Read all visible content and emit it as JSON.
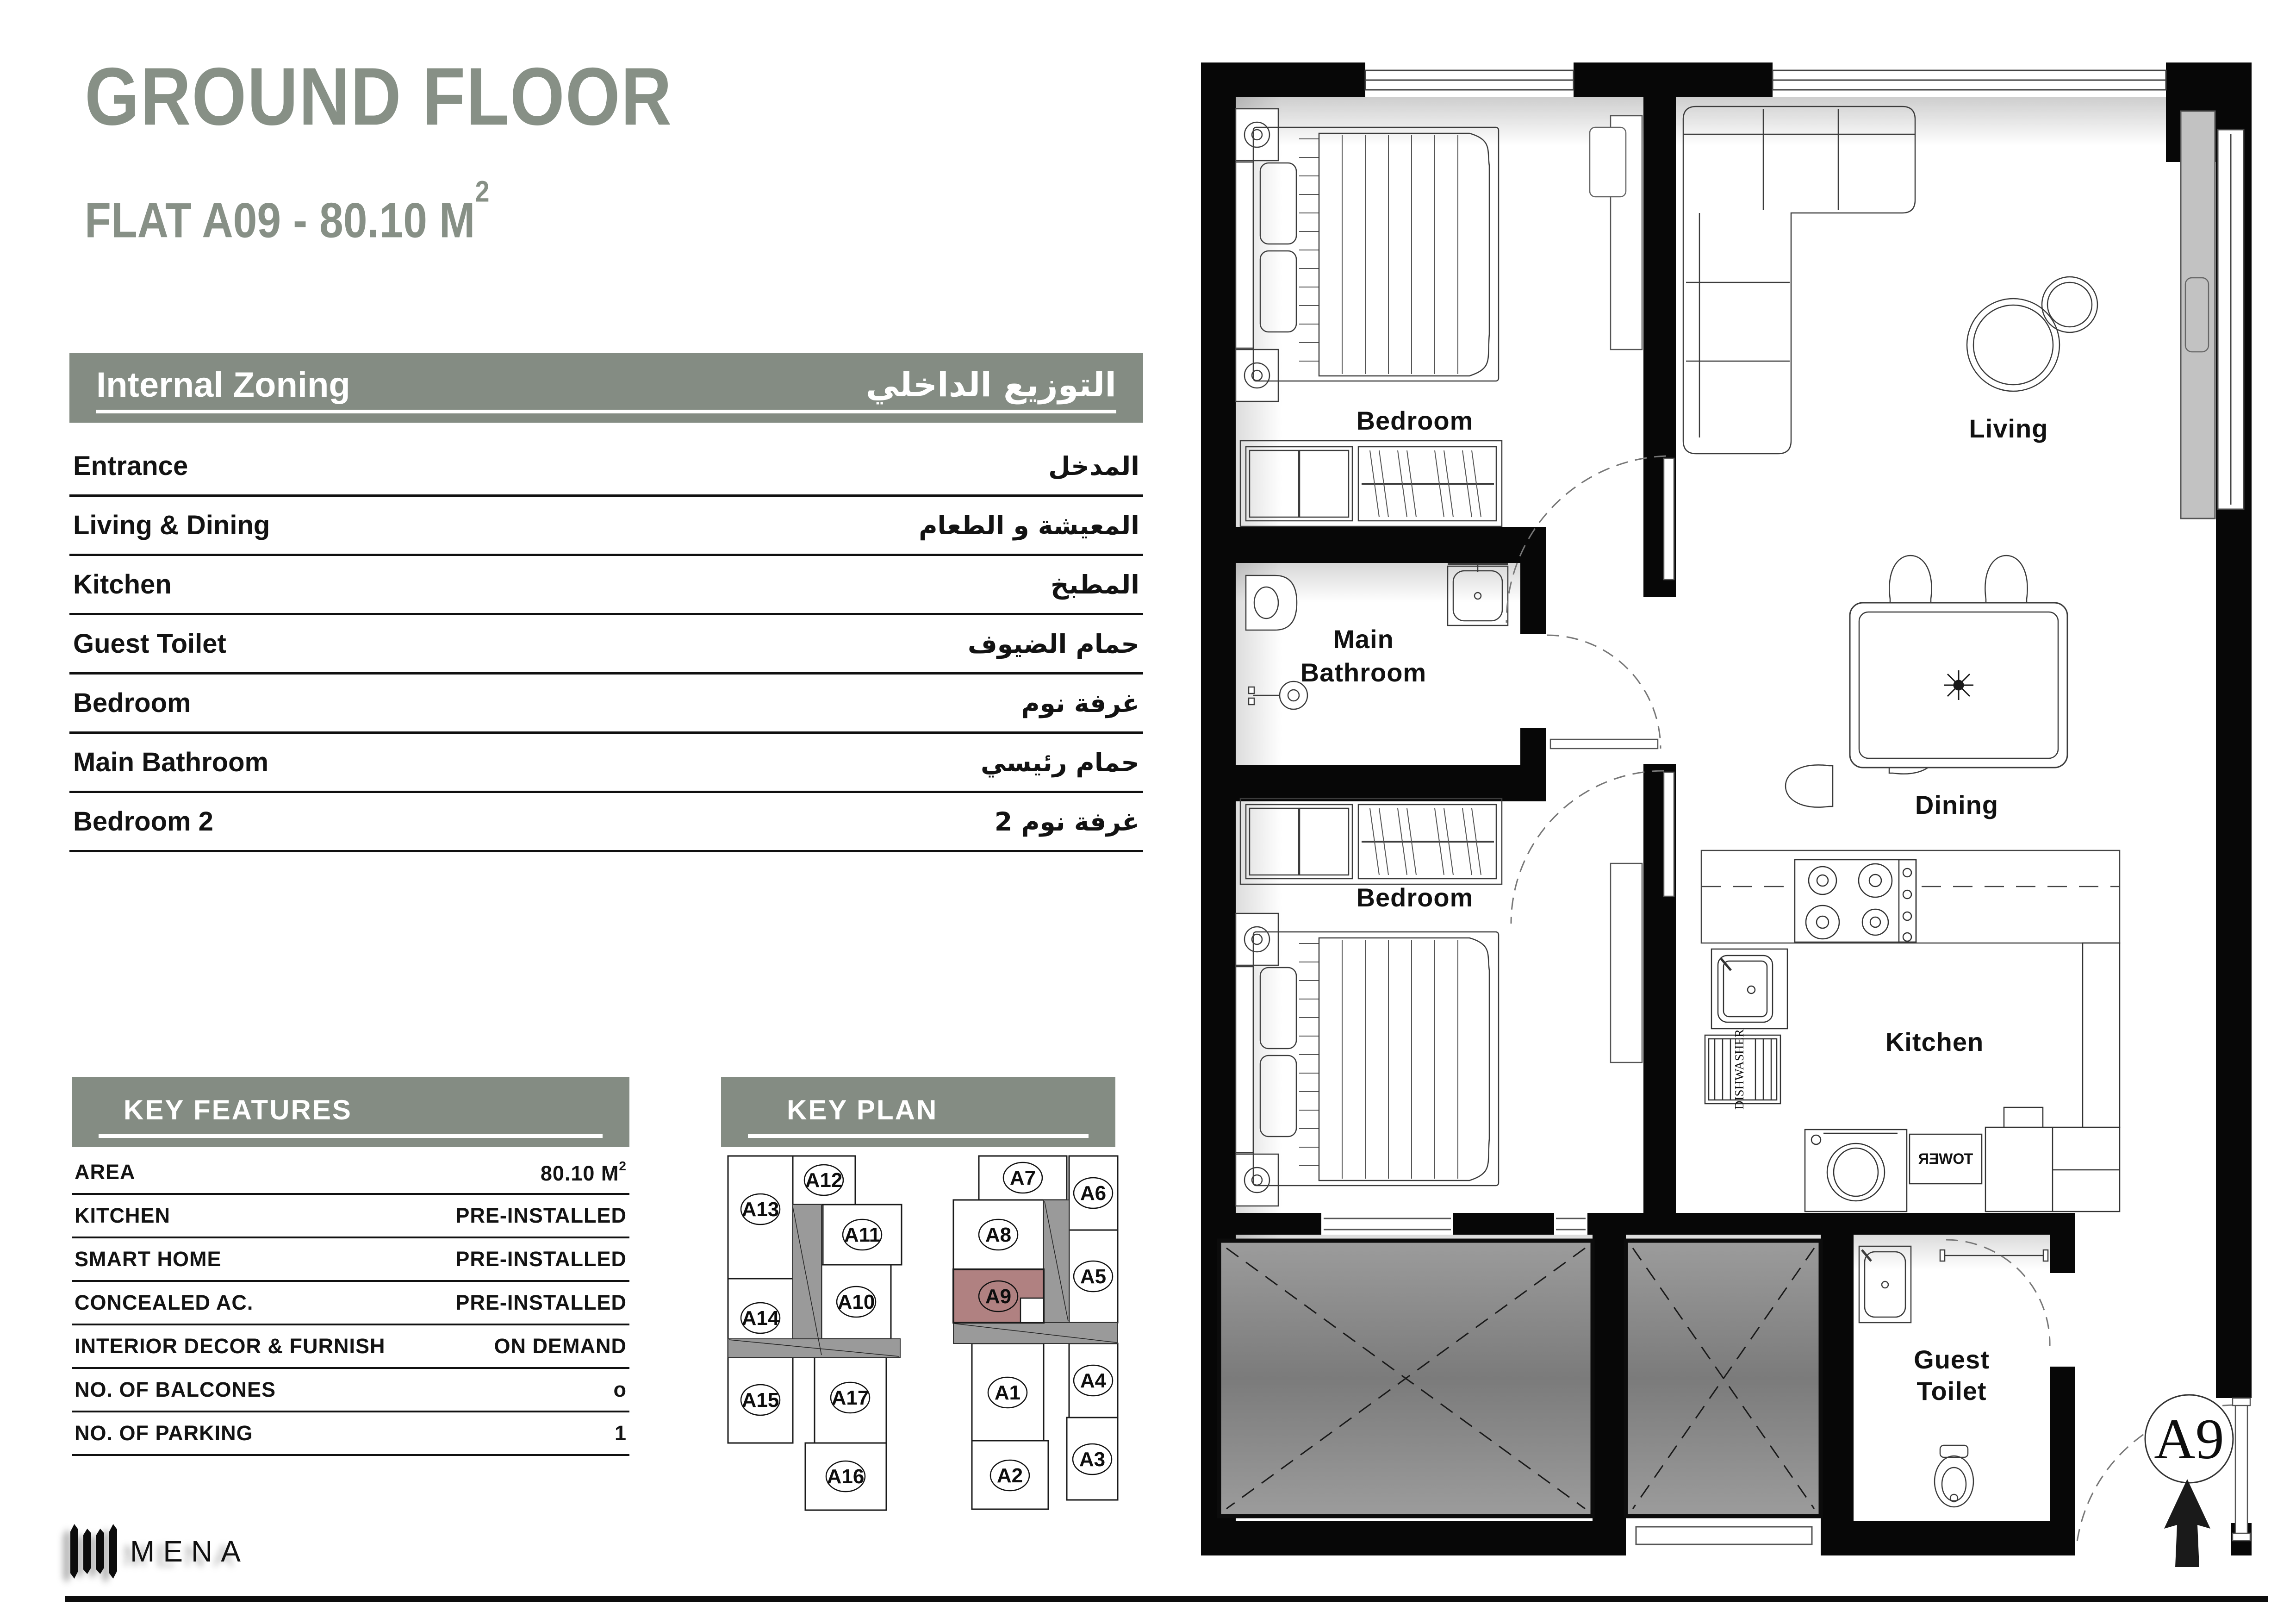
{
  "title": {
    "line1": "GROUND FLOOR",
    "line2": "FLAT A09 - 80.10 M",
    "area_sup": "2"
  },
  "zoning": {
    "header_en": "Internal Zoning",
    "header_ar": "التوزيع الداخلي",
    "rows": [
      {
        "en": "Entrance",
        "ar": "المدخل"
      },
      {
        "en": "Living & Dining",
        "ar": "المعيشة و الطعام"
      },
      {
        "en": "Kitchen",
        "ar": "المطبخ"
      },
      {
        "en": "Guest Toilet",
        "ar": "حمام الضيوف"
      },
      {
        "en": "Bedroom",
        "ar": "غرفة نوم"
      },
      {
        "en": "Main Bathroom",
        "ar": "حمام رئيسي"
      },
      {
        "en": "Bedroom 2",
        "ar": "غرفة نوم 2"
      }
    ]
  },
  "key_features": {
    "header": "KEY FEATURES",
    "rows": [
      {
        "label": "AREA",
        "value": "80.10 M",
        "sup": "2"
      },
      {
        "label": "KITCHEN",
        "value": "PRE-INSTALLED"
      },
      {
        "label": "SMART HOME",
        "value": "PRE-INSTALLED"
      },
      {
        "label": "CONCEALED AC.",
        "value": "PRE-INSTALLED"
      },
      {
        "label": "INTERIOR DECOR & FURNISH",
        "value": "ON DEMAND"
      },
      {
        "label": "NO. OF BALCONES",
        "value": "o"
      },
      {
        "label": "NO. OF PARKING",
        "value": "1"
      }
    ]
  },
  "key_plan": {
    "header": "KEY PLAN",
    "highlighted_unit": "A9",
    "units": [
      "A13",
      "A12",
      "A11",
      "A14",
      "A10",
      "A15",
      "A17",
      "A16",
      "A7",
      "A6",
      "A8",
      "A9",
      "A5",
      "A4",
      "A1",
      "A3",
      "A2"
    ]
  },
  "floor_plan": {
    "rooms": {
      "bedroom1": "Bedroom",
      "living": "Living",
      "main_bath_1": "Main",
      "main_bath_2": "Bathroom",
      "dining": "Dining",
      "bedroom2": "Bedroom",
      "kitchen": "Kitchen",
      "guest_1": "Guest",
      "guest_2": "Toilet"
    },
    "appliances": {
      "dishwasher": "DISHWASHER",
      "tower": "TOWER"
    },
    "unit_marker": "A9"
  },
  "footer": {
    "brand": "MENA"
  },
  "colors": {
    "accent_green": "#848c83",
    "title_green": "#879086",
    "unit_highlight": "#b08181",
    "corridor_gray": "#9a9a9a",
    "shaft_gray": "#8a8a8a"
  }
}
